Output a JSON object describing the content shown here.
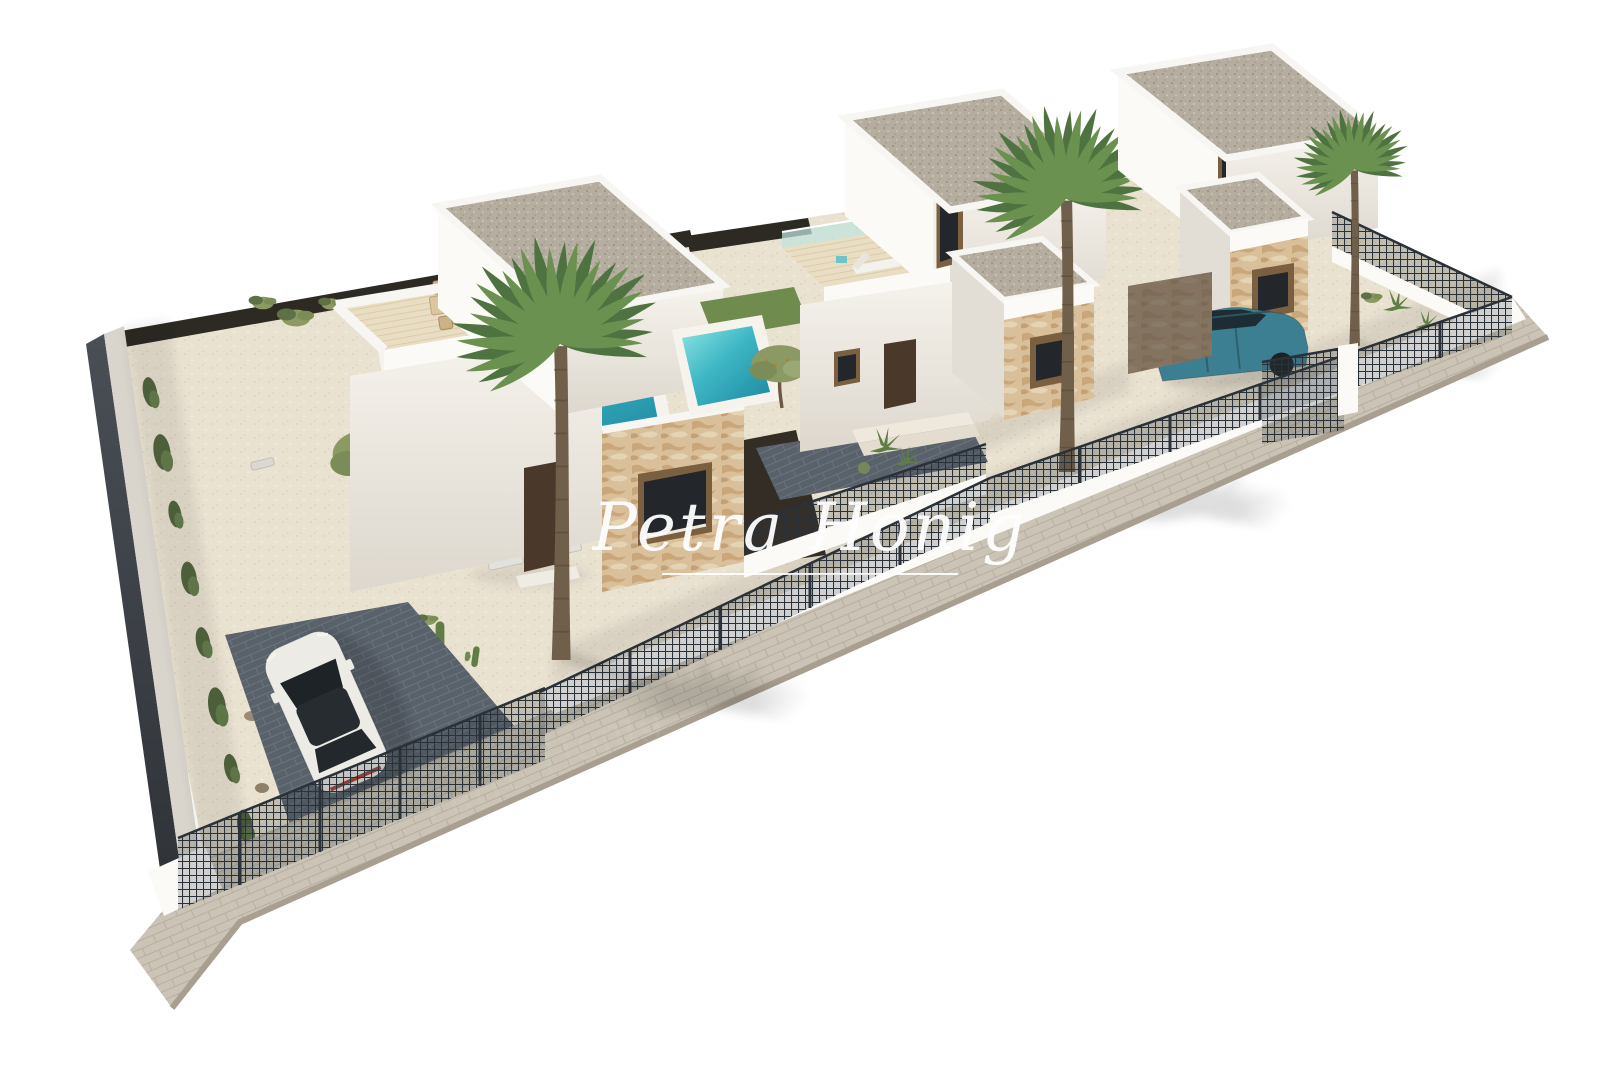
{
  "watermark": {
    "text": "Petra Honig"
  },
  "palette": {
    "ground": "#eae2d1",
    "hedge": "#2d2a24",
    "wall_lit": "#fbfaf7",
    "wall_shade": "#e2ddd5",
    "stone": "#d9bf9a",
    "lawn": "#6f8c4e",
    "pool_light": "#8ce4e4",
    "pool_deep": "#1d87a0",
    "glass_balustrade": "#bfe3dc",
    "fence_dark": "#2b3138",
    "sidewalk": "#cbc4b6",
    "curb": "#a89f91",
    "drive": "#59616b",
    "car_white": "#ecebe6",
    "car_blue": "#3c7f93",
    "glass_dark": "#23272b",
    "door_brown": "#4a392b",
    "frame_brown": "#7a5f40",
    "palm_dark": "#4f7340",
    "palm_light": "#6b9150",
    "trunk": "#6f5f4b",
    "olive": "#8b9a63",
    "watermark": "#ffffff"
  },
  "scene": {
    "type": "3d-exterior-architectural-render",
    "objects": [
      "white-villa-left",
      "white-villa-middle",
      "white-villa-right",
      "swimming-pool-left",
      "swimming-pool-middle",
      "lawn-strip",
      "roof-terrace-dining-set",
      "roof-terrace-sun-lounger",
      "potted-palm",
      "fan-palm-trees",
      "olive-trees",
      "cacti-and-agaves",
      "climbing-plants",
      "white-suv-car",
      "teal-suv-car",
      "dark-mesh-perimeter-fence",
      "dark-hedge",
      "paved-sidewalk",
      "dark-paved-driveways",
      "gravel-gardens",
      "glass-balustrades",
      "stone-clad-accent-walls",
      "gravel-flat-roofs"
    ]
  }
}
